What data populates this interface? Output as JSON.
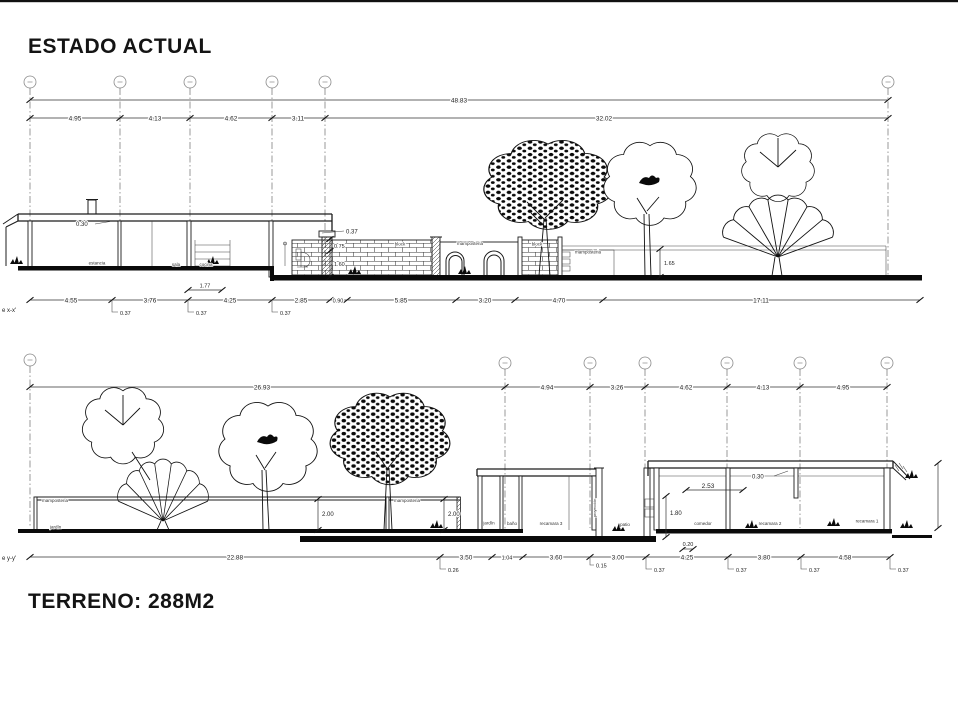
{
  "page": {
    "title": "ESTADO ACTUAL",
    "terrain": "TERRENO: 288M2"
  },
  "section_x": {
    "cut_label": "e x-x'",
    "overall": "48.83",
    "grid_dims": [
      "4.95",
      "4.13",
      "4.62",
      "3.11",
      "32.02"
    ],
    "bottom_dims": [
      "4.55",
      "3.76",
      "4.25",
      "2.85",
      "0.90",
      "5.85",
      "3.20",
      "4.70",
      "17.11"
    ],
    "sub_dims": [
      "0.37",
      "0.37",
      "0.37"
    ],
    "stair_dim": "1.77",
    "roof_thickness": "0.30",
    "wall_cap": "0.37",
    "wall_upper": "0.75",
    "wall_lower": "1.60",
    "wall_height": "1.65",
    "wall_labels": [
      "block",
      "mamposteria",
      "block",
      "mamposteria"
    ],
    "rooms": [
      "estancia",
      "sala",
      "cocina"
    ]
  },
  "section_y": {
    "cut_label": "e y-y'",
    "overall": "26.93",
    "grid_dims": [
      "4.94",
      "3.26",
      "4.62",
      "4.13",
      "4.95"
    ],
    "bottom_dims": [
      "22.88",
      "3.50",
      "1.04",
      "3.60",
      "3.00",
      "4.25",
      "3.80",
      "4.58"
    ],
    "sub_dims": [
      "0.26",
      "0.15",
      "0.37",
      "0.37",
      "0.37",
      "0.37"
    ],
    "step_dim": "0.20",
    "wall_heights": [
      "2.00",
      "2.00"
    ],
    "roof_thickness": "0.30",
    "eave_dim": "2.53",
    "patio_height": "1.80",
    "wall_labels": [
      "mamposteria",
      "mamposteria"
    ],
    "garden_label": "jardín",
    "projection_label": "proyección",
    "rooms": [
      "jardín",
      "baño",
      "recamara 3",
      "patio",
      "comedor",
      "recamara 2",
      "recamara 1"
    ]
  }
}
